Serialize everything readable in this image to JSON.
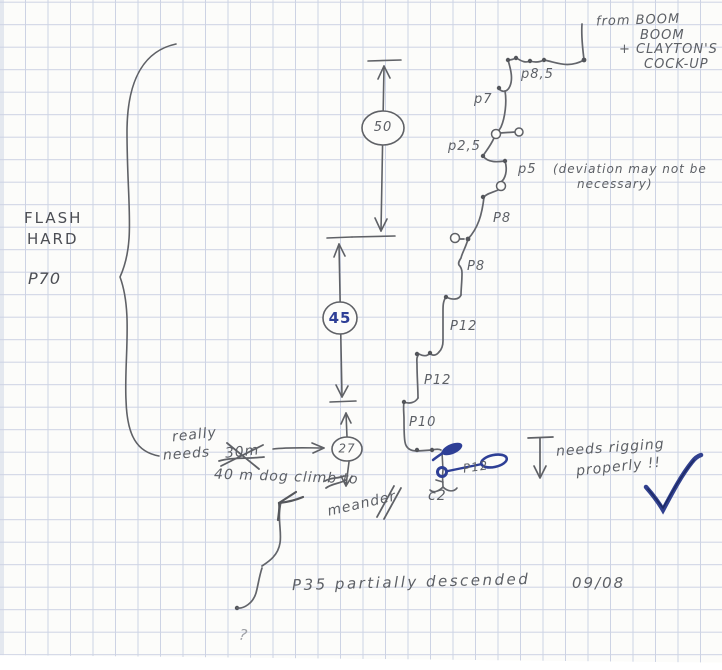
{
  "sketch": {
    "source_note": {
      "l1": "from BOOM",
      "l2": "BOOM",
      "l3": "+ CLAYTON'S",
      "l4": "COCK-UP"
    },
    "left_label": {
      "l1": "FLASH",
      "l2": "HARD",
      "pitch": "P70"
    },
    "depths": {
      "d50": "50",
      "d45": "45",
      "d27": "27"
    },
    "pitch_labels": {
      "p85": "p8,5",
      "p7": "p7",
      "p25": "p2,5",
      "p5": "p5",
      "p5_note1": "(deviation may not be",
      "p5_note2": "necessary)",
      "p8a": "P8",
      "p8b": "P8",
      "p12a": "P12",
      "p12b": "P12",
      "p10": "P10",
      "p12c": "P12"
    },
    "notes": {
      "really1": "really",
      "really2": "needs",
      "crossed": "30m",
      "climb": "40 m dog climb to",
      "meander": "meander",
      "c2": "c2",
      "rig1": "needs rigging",
      "rig2": "properly !!",
      "bottom": "P35 partially descended",
      "date": "09/08",
      "question": "?"
    },
    "colors": {
      "pencil": "#5f6166",
      "blue_pen": "#2e3f96",
      "grid": "#cdd3e4",
      "paper": "#fcfcfa"
    }
  }
}
